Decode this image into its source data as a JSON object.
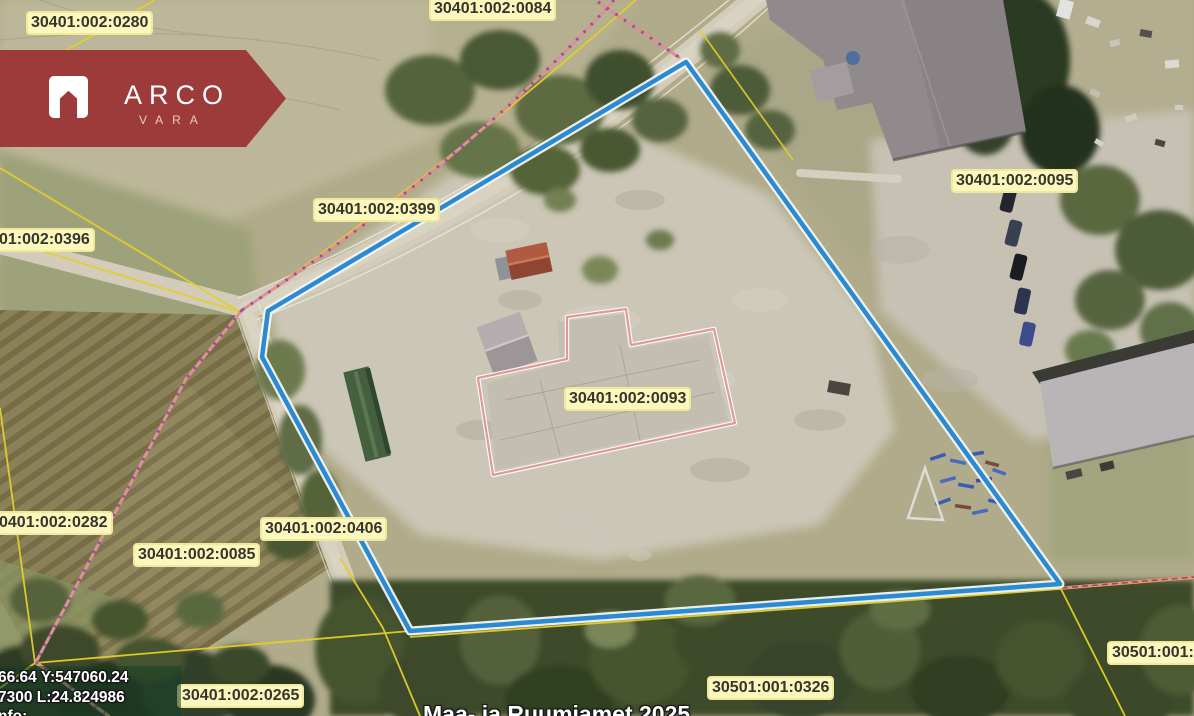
{
  "branding": {
    "logo_text": "ARCO",
    "logo_subtext": "VARA",
    "ribbon_color": "#9d3b3b"
  },
  "map": {
    "parcel_labels": [
      {
        "id": "0280",
        "text": "30401:002:0280"
      },
      {
        "id": "0084",
        "text": "30401:002:0084"
      },
      {
        "id": "0399",
        "text": "30401:002:0399"
      },
      {
        "id": "0396",
        "text": "01:002:0396"
      },
      {
        "id": "0095",
        "text": "30401:002:0095"
      },
      {
        "id": "0093",
        "text": "30401:002:0093"
      },
      {
        "id": "0282",
        "text": "0401:002:0282"
      },
      {
        "id": "0085",
        "text": "30401:002:0085"
      },
      {
        "id": "0406",
        "text": "30401:002:0406"
      },
      {
        "id": "0265",
        "text": "30401:002:0265"
      },
      {
        "id": "0326",
        "text": "30501:001:0326"
      },
      {
        "id": "30501",
        "text": "30501:001:0"
      }
    ],
    "coordinate_readout": {
      "line1": "66.64 Y:547060.24",
      "line2": "7300 L:24.824986",
      "line3": "nfo:"
    },
    "attribution": "Maa- ja Ruumiamet 2025",
    "colors": {
      "selection_outline_blue": "#2a8ad4",
      "cadastral_line_yellow": "#e3cf2a",
      "boundary_dashed_salmon": "#db9292",
      "boundary_dot_purple": "#9a4f9e",
      "parcel_outline_pink": "#e09999",
      "label_background": "#fbf7bd"
    }
  }
}
